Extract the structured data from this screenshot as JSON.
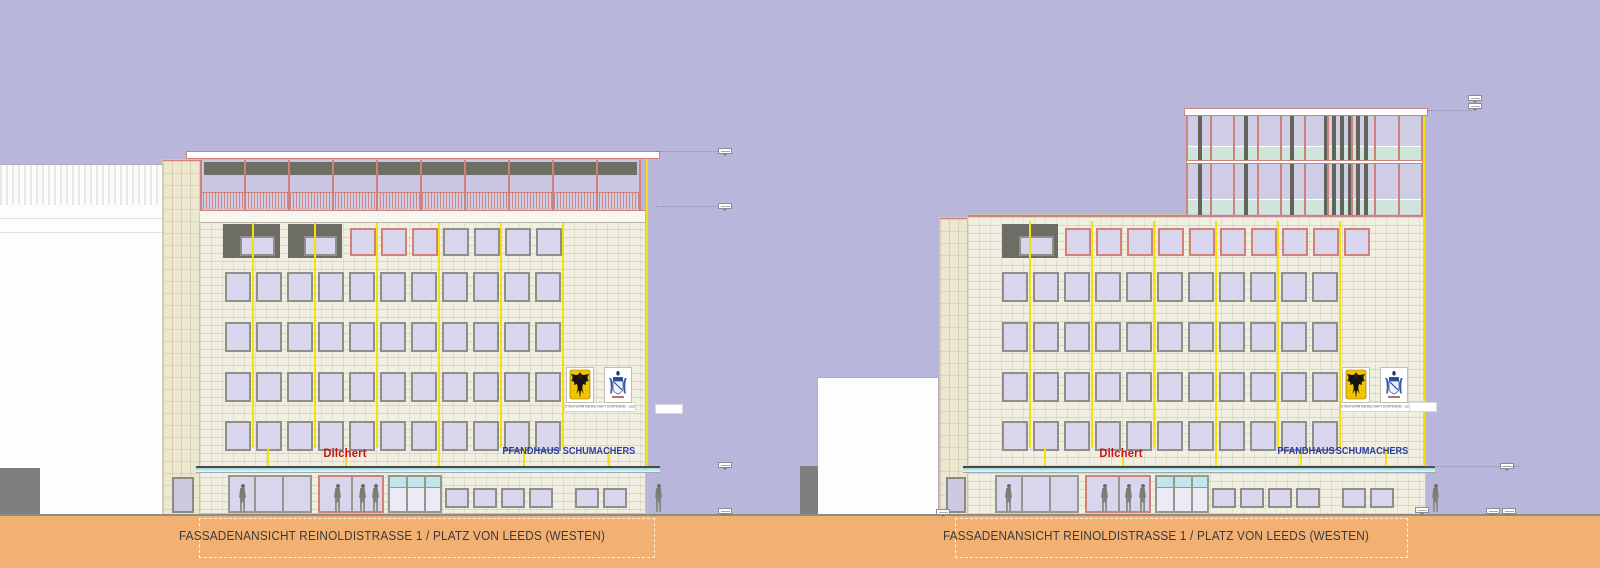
{
  "sheet": {
    "type": "architectural facade elevation drawing, two variants side by side",
    "signs": {
      "dilchert": "Dilchert",
      "pfandhaus": "PFANDHAUS",
      "schumachers": "SCHUMACHERS"
    },
    "crest_caption": "STÄDTEPARTNERSCHAFT DORTMUND - LEEDS",
    "crests": [
      "dortmund-eagle-crest",
      "leeds-coat-of-arms"
    ],
    "colors": {
      "sky": "#b9b6db",
      "facade": "#f1efe2",
      "window": "#d8d5ec",
      "frame_gray": "#8f8f8a",
      "frame_pink": "#cf8278",
      "joint_yellow": "#f2e20a",
      "recess_dark": "#6d6d66",
      "ground": "#f2b173",
      "sign_red": "#cc1111",
      "sign_blue": "#2b3c9e",
      "canopy_teal": "#9fd2da"
    },
    "views": [
      {
        "label": "variant-a",
        "title": "FASSADENANSICHT REINOLDISTRASSE 1 / PLATZ VON LEEDS (WESTEN)",
        "floors": 4,
        "windows_per_floor": 11,
        "top_floor": {
          "balcony_recesses": 2,
          "pink_framed_windows": 3,
          "gray_framed_windows": 4
        },
        "roof": "full-width glass penthouse with roof terrace railing"
      },
      {
        "label": "variant-b",
        "title": "FASSADENANSICHT REINOLDISTRASSE 1 / PLATZ VON LEEDS (WESTEN)",
        "floors": 4,
        "windows_per_floor": 11,
        "top_floor": {
          "balcony_recesses": 1,
          "pink_framed_windows": 10,
          "gray_framed_windows": 0
        },
        "roof": "two-storey glazed rooftop extension over right half"
      }
    ]
  }
}
